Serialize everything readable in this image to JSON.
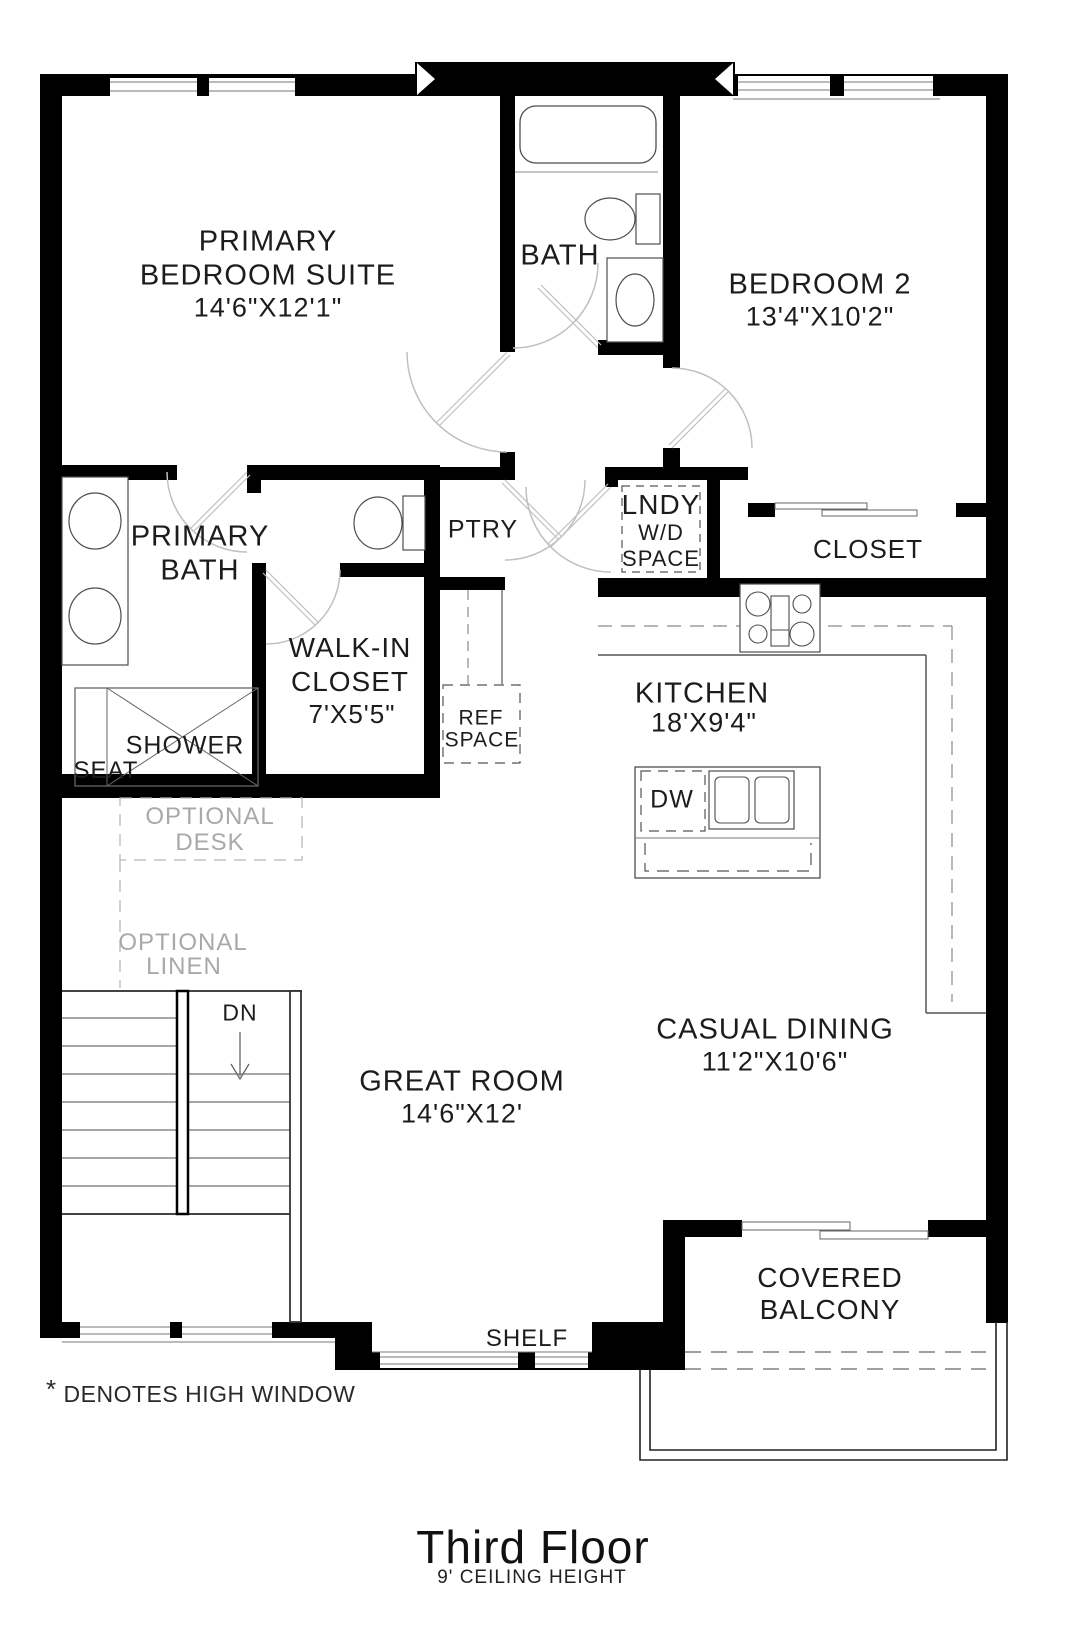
{
  "floor_plan": {
    "title": {
      "main": "Third Floor",
      "sub": "9' CEILING HEIGHT"
    },
    "footnote": {
      "star": "*",
      "text": "DENOTES HIGH WINDOW"
    },
    "colors": {
      "wall": "#000000",
      "fixture_line": "#4d4d4d",
      "door_arc": "#c0c0c0",
      "optional_gray": "#a9a9a9"
    },
    "labels": {
      "primary_bedroom_1": "PRIMARY",
      "primary_bedroom_2": "BEDROOM SUITE",
      "primary_bedroom_dims": "14'6\"X12'1\"",
      "bath": "BATH",
      "bedroom2": "BEDROOM 2",
      "bedroom2_dims": "13'4\"X10'2\"",
      "primary_bath_1": "PRIMARY",
      "primary_bath_2": "BATH",
      "wic_1": "WALK-IN",
      "wic_2": "CLOSET",
      "wic_dims": "7'X5'5\"",
      "ptry": "PTRY",
      "lndy_1": "LNDY",
      "lndy_2": "W/D",
      "lndy_3": "SPACE",
      "closet": "CLOSET",
      "kitchen": "KITCHEN",
      "kitchen_dims": "18'X9'4\"",
      "shower": "SHOWER",
      "seat": "SEAT",
      "ref_1": "REF",
      "ref_2": "SPACE",
      "dw": "DW",
      "optional_desk_1": "OPTIONAL",
      "optional_desk_2": "DESK",
      "optional_linen_1": "OPTIONAL",
      "optional_linen_2": "LINEN",
      "dn": "DN",
      "great_room": "GREAT ROOM",
      "great_room_dims": "14'6\"X12'",
      "casual_dining": "CASUAL DINING",
      "casual_dining_dims": "11'2\"X10'6\"",
      "balcony_1": "COVERED",
      "balcony_2": "BALCONY",
      "shelf": "SHELF"
    }
  }
}
